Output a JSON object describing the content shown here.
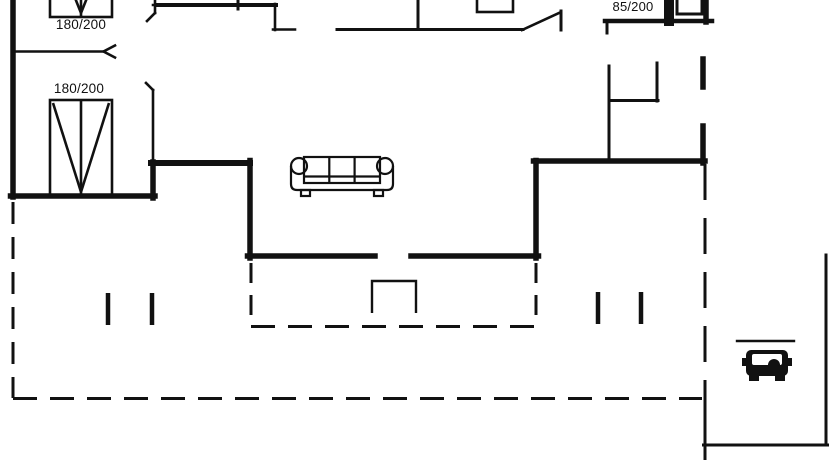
{
  "palette": {
    "background": "#ffffff",
    "line": "#111111"
  },
  "labels": {
    "bed1": "180/200",
    "bed2": "180/200",
    "bed3": "85/200"
  },
  "symbols": {
    "beds": [
      {
        "icon": "double-bed-icon",
        "size_label": "180/200"
      },
      {
        "icon": "double-bed-icon",
        "size_label": "180/200"
      },
      {
        "icon": "single-bed-icon",
        "size_label": "85/200"
      }
    ],
    "furniture": [
      {
        "icon": "sofa-icon"
      }
    ],
    "vehicle": {
      "icon": "car-icon"
    },
    "other": [
      {
        "icon": "terrace-step-icon"
      },
      {
        "icon": "door-swing-icon"
      },
      {
        "icon": "door-chevron-icon"
      },
      {
        "icon": "pergola-post"
      }
    ]
  }
}
